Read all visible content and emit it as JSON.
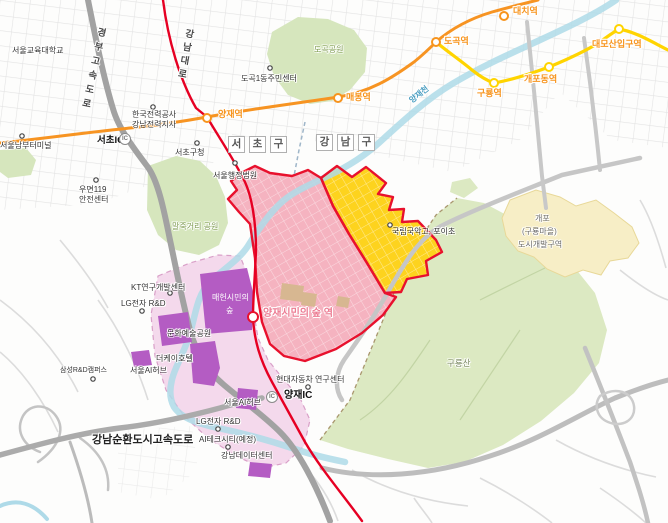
{
  "map_type": "city-development-zone-map",
  "districts": {
    "seocho_chars": [
      "서",
      "초",
      "구"
    ],
    "gangnam_chars": [
      "강",
      "남",
      "구"
    ]
  },
  "roads": {
    "gyeongbu_expressway": "경부고속도로",
    "gangnam_daero": "강남대로",
    "gangnam_beltway": "강남순환도시고속도로",
    "seocho_ic": "서초IC",
    "yangjae_ic": "양재IC",
    "ic_badge": "IC"
  },
  "subway": {
    "line3_color": "#f7941d",
    "bundang_color": "#ffd400",
    "route_color": "#e60023",
    "stations": {
      "yangjae": "양재역",
      "maebong": "매봉역",
      "dogok": "도곡역",
      "daechi": "대치역",
      "guryong": "구룡역",
      "gaepodong": "개포동역",
      "daemosan": "대모산입구역",
      "citizens_forest": "양재시민의 숲 역"
    }
  },
  "places": {
    "snue": "서울교육대학교",
    "nambu_terminal": "서울남부터미널",
    "kepco_line1": "한국전력공사",
    "kepco_line2": "강남전력지사",
    "seocho_office": "서초구청",
    "admin_court": "서울행정법원",
    "umyeon119_line1": "우면119",
    "umyeon119_line2": "안전센터",
    "dogok1_center": "도곡1동주민센터",
    "gukak_school": "국립국악고, 포이초",
    "kt_rnd": "KT연구개발센터",
    "lg_rnd": "LG전자 R&D",
    "lg_rnd2": "LG전자 R&D",
    "samsung_rnd": "삼성R&D캠퍼스",
    "seoul_ai_hub": "서울AI허브",
    "seoul_ai_hub2": "서울AI허브",
    "thek_hotel": "더케이호텔",
    "hyundai_research": "현대자동차 연구센터",
    "ai_tech_city": "AI테크시티(예정)",
    "gangnam_datacenter": "강남데이터센터"
  },
  "parks": {
    "dogok_park": "도곡공원",
    "maljukgeori_park": "말죽거리 공원",
    "maeheon_forest_line1": "매헌시민의",
    "maeheon_forest_line2": "숲",
    "culture_art_park": "문화예술공원",
    "guryongsan": "구룡산"
  },
  "river": {
    "yangjaecheon": "양재천",
    "color": "#aedae8"
  },
  "zones": {
    "gaepo_line1": "개포",
    "gaepo_line2": "(구룡마을)",
    "gaepo_line3": "도시개발구역",
    "pink_fill": "#f5b3c0",
    "yellow_fill": "#fdd31e",
    "lightpink_fill": "#f4d9ec",
    "purple_fill": "#b45cc3",
    "cream_fill": "#f7eec6",
    "park_fill": "#d6e6bd",
    "border_red": "#e8112d"
  }
}
